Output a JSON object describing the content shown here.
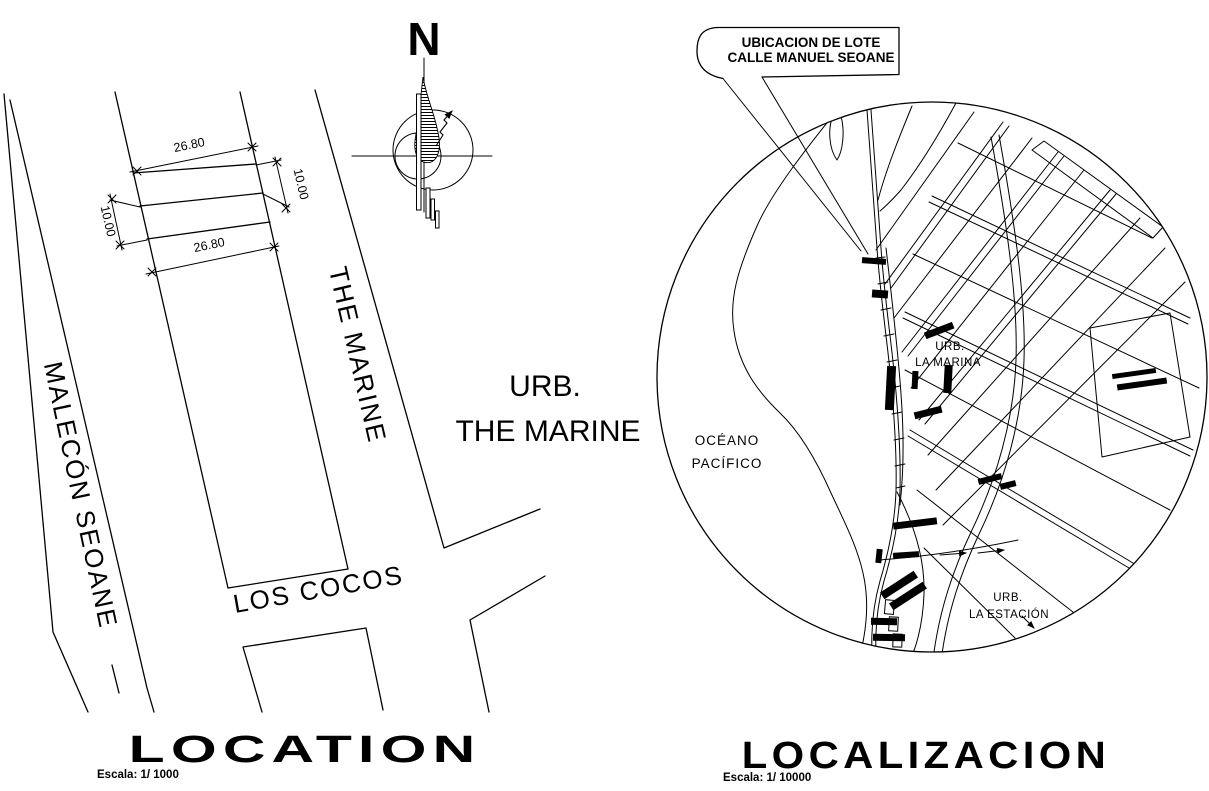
{
  "colors": {
    "ink": "#000000",
    "paper": "#ffffff"
  },
  "location_plan": {
    "title": "LOCATION",
    "scale_label": "Escala: 1/ 1000",
    "compass": {
      "north_label": "N"
    },
    "streets": {
      "malecon_seoane": "MALECÓN SEOANE",
      "the_marine": "THE MARINE",
      "los_cocos": "LOS COCOS"
    },
    "urbanization": {
      "line1": "URB.",
      "line2": "THE MARINE"
    },
    "dimensions": {
      "top_width": "26.80",
      "bottom_width": "26.80",
      "left_depth": "10.00",
      "right_depth": "10.00"
    }
  },
  "localization_plan": {
    "title": "LOCALIZACION",
    "scale_label": "Escala: 1/ 10000",
    "callout": {
      "line1": "UBICACION DE LOTE",
      "line2": "CALLE MANUEL SEOANE"
    },
    "ocean": {
      "line1": "OCÉANO",
      "line2": "PACÍFICO"
    },
    "urb_la_marina": {
      "line1": "URB.",
      "line2": "LA MARINA"
    },
    "urb_la_estacion": {
      "line1": "URB.",
      "line2": "LA ESTACIÓN"
    }
  }
}
